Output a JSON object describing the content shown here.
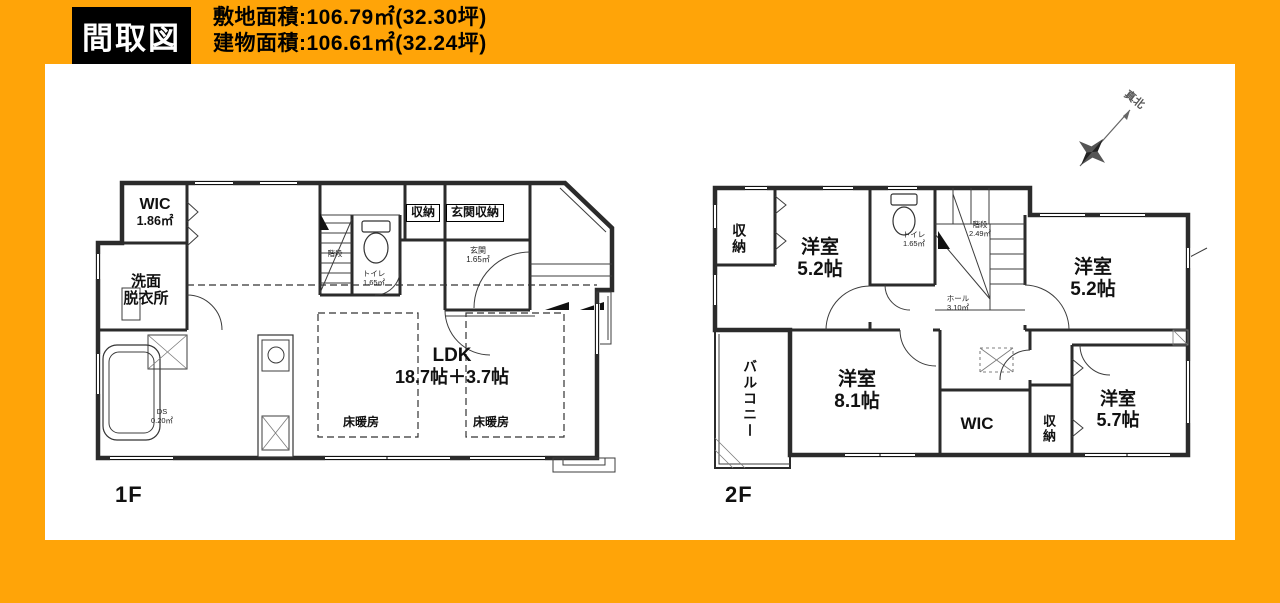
{
  "header": {
    "badge": "間取図",
    "site_area": "敷地面積:106.79㎡(32.30坪)",
    "building_area": "建物面積:106.61㎡(32.24坪)"
  },
  "colors": {
    "background": "#FFA408",
    "badge_bg": "#000000",
    "badge_text": "#FFFFFF",
    "panel_bg": "#FFFFFF",
    "line": "#2B2B2B"
  },
  "floor1": {
    "label": "1F",
    "rooms": {
      "wic": {
        "name": "WIC",
        "size": "1.86㎡"
      },
      "senmen": {
        "line1": "洗面",
        "line2": "脱衣所"
      },
      "ldk": {
        "name": "LDK",
        "size": "18.7帖＋3.7帖"
      },
      "yukadanbo1": {
        "name": "床暖房"
      },
      "yukadanbo2": {
        "name": "床暖房"
      },
      "shuno": {
        "name": "収納"
      },
      "genkan_shuno": {
        "name": "玄関収納"
      },
      "genkan": {
        "name": "玄関",
        "size": "1.65㎡"
      },
      "toilet": {
        "name": "トイレ",
        "size": "1.65㎡"
      },
      "kaidan": {
        "name": "階段"
      },
      "ds": {
        "name": "DS",
        "size": "0.20㎡"
      }
    }
  },
  "floor2": {
    "label": "2F",
    "compass": "真北",
    "rooms": {
      "shuno_nw": {
        "name": "収納"
      },
      "yoshitsu_52a": {
        "name": "洋室",
        "size": "5.2帖"
      },
      "toilet": {
        "name": "トイレ",
        "size": "1.65㎡"
      },
      "kaidan": {
        "name": "階段",
        "size": "2.49㎡"
      },
      "hall": {
        "name": "ホール",
        "size": "3.10㎡"
      },
      "yoshitsu_52b": {
        "name": "洋室",
        "size": "5.2帖"
      },
      "balcony": {
        "name": "バルコニー"
      },
      "yoshitsu_81": {
        "name": "洋室",
        "size": "8.1帖"
      },
      "wic": {
        "name": "WIC"
      },
      "shuno_se": {
        "name": "収納"
      },
      "yoshitsu_57": {
        "name": "洋室",
        "size": "5.7帖"
      }
    }
  }
}
